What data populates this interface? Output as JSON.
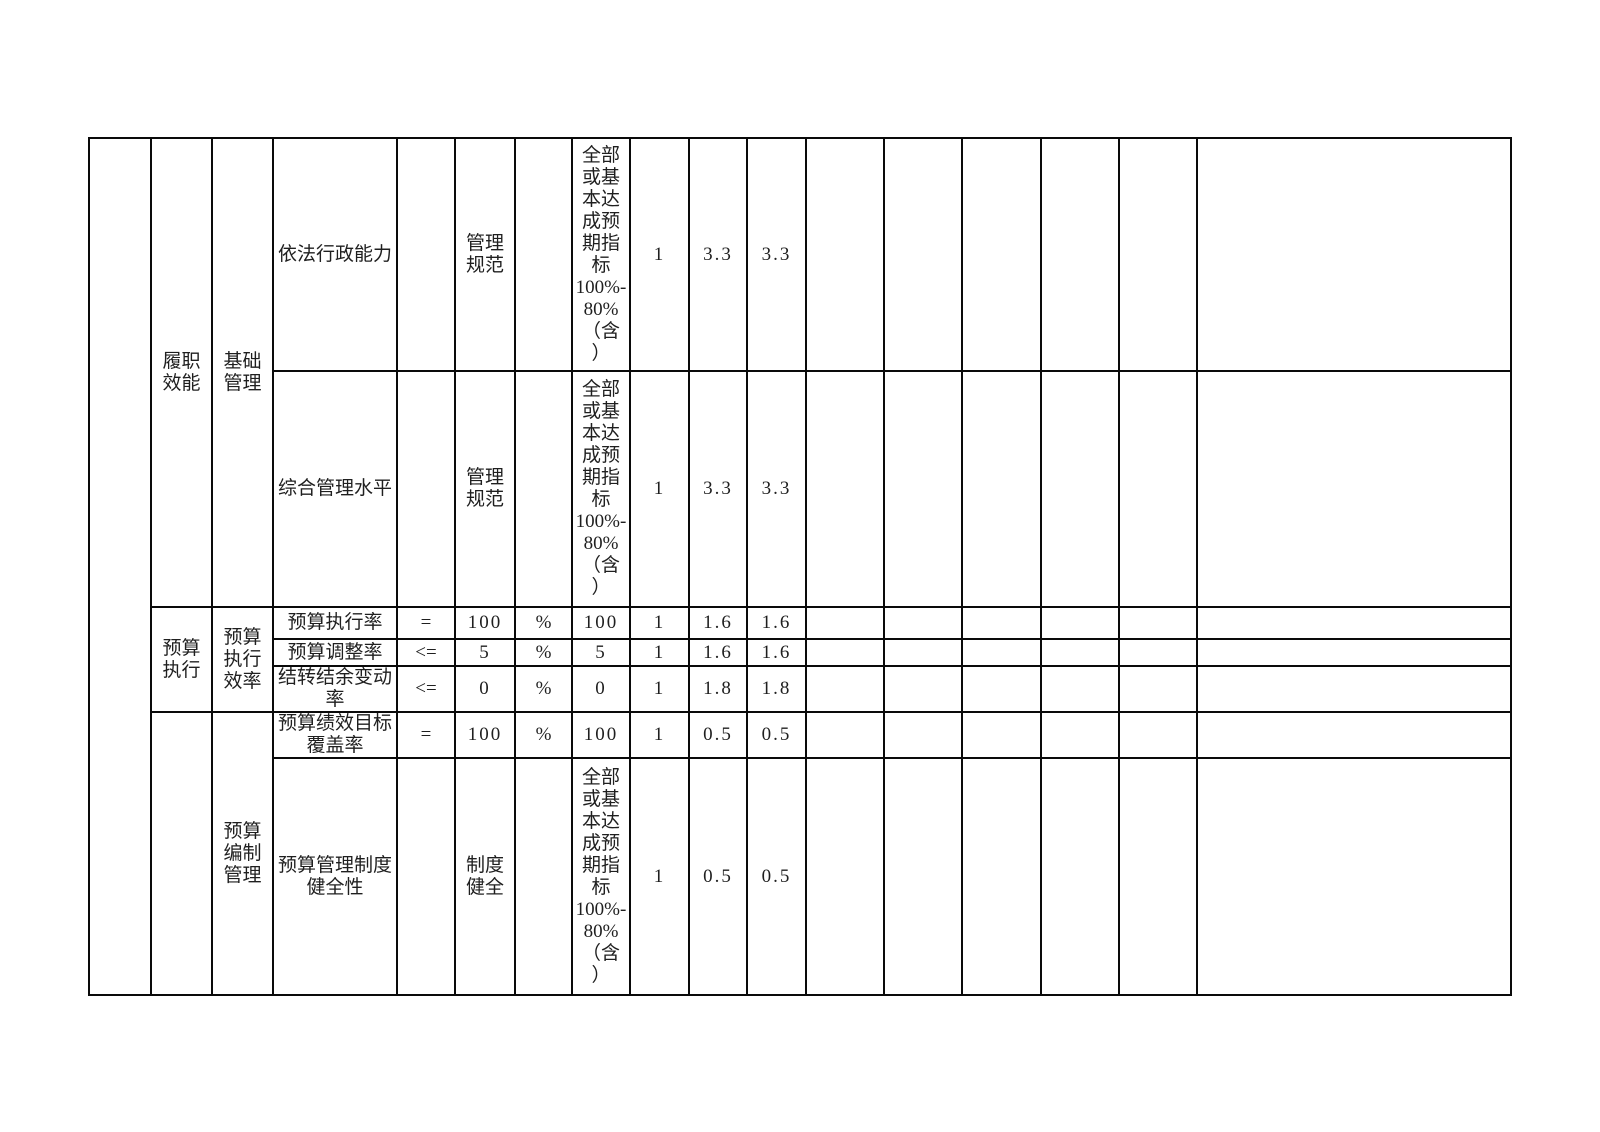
{
  "colors": {
    "background": "#ffffff",
    "border": "#0a0a0a",
    "text": "#1f1f1f"
  },
  "table": {
    "description_visible_text_only": "performance indicator grid fragment",
    "rows": [
      {
        "level1": "履职\n效能",
        "level2": "基础\n管理",
        "indicator": "依法行政能力",
        "operator": "",
        "value": "管理\n规范",
        "unit": "",
        "criteria": "全部\n或基\n本达\n成预\n期指\n标\n100%-\n80%\n（含\n）",
        "weight": "1",
        "score_a": "3.3",
        "score_b": "3.3"
      },
      {
        "indicator": "综合管理水平",
        "operator": "",
        "value": "管理\n规范",
        "unit": "",
        "criteria": "全部\n或基\n本达\n成预\n期指\n标\n100%-\n80%\n（含\n）",
        "weight": "1",
        "score_a": "3.3",
        "score_b": "3.3"
      },
      {
        "level1": "预算\n执行",
        "level2": "预算\n执行\n效率",
        "indicator": "预算执行率",
        "operator": "=",
        "value": "100",
        "unit": "%",
        "criteria": "100",
        "weight": "1",
        "score_a": "1.6",
        "score_b": "1.6"
      },
      {
        "indicator": "预算调整率",
        "operator": "<=",
        "value": "5",
        "unit": "%",
        "criteria": "5",
        "weight": "1",
        "score_a": "1.6",
        "score_b": "1.6"
      },
      {
        "indicator": "结转结余变动\n率",
        "operator": "<=",
        "value": "0",
        "unit": "%",
        "criteria": "0",
        "weight": "1",
        "score_a": "1.8",
        "score_b": "1.8"
      },
      {
        "level1": "",
        "level2": "预算\n编制\n管理",
        "indicator": "预算绩效目标\n覆盖率",
        "operator": "=",
        "value": "100",
        "unit": "%",
        "criteria": "100",
        "weight": "1",
        "score_a": "0.5",
        "score_b": "0.5"
      },
      {
        "indicator": "预算管理制度\n健全性",
        "operator": "",
        "value": "制度\n健全",
        "unit": "",
        "criteria": "全部\n或基\n本达\n成预\n期指\n标\n100%-\n80%\n（含\n）",
        "weight": "1",
        "score_a": "0.5",
        "score_b": "0.5"
      }
    ]
  }
}
